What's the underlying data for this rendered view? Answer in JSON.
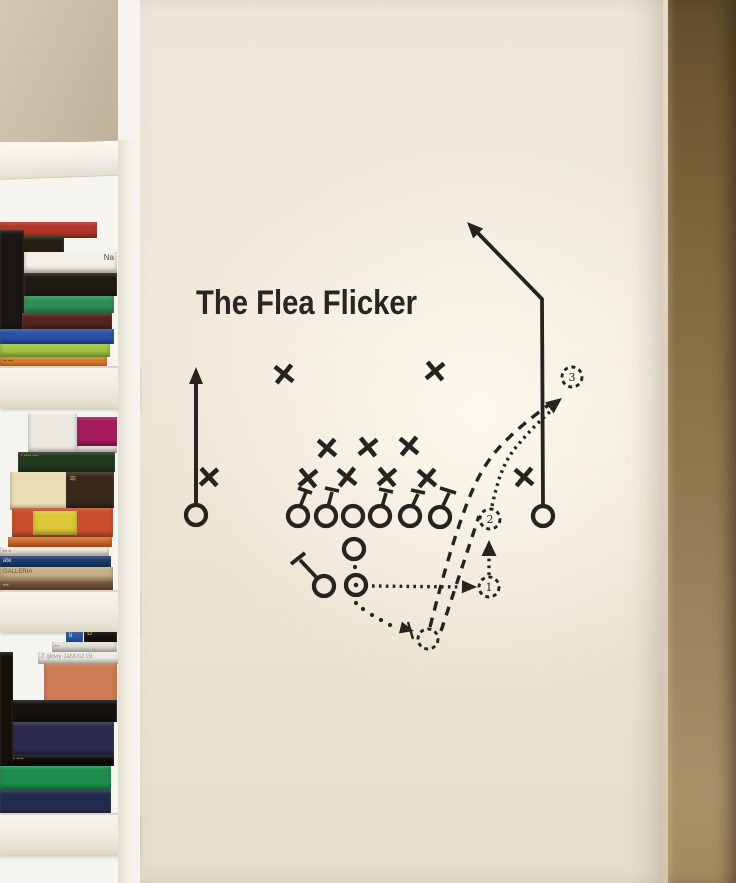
{
  "palette": {
    "ink": "#29231f",
    "wall_base": "#ece6d8",
    "shelf_white": "#f6f4ee",
    "upper_beige": "#c9bda8",
    "side_top": "#5e4c2b",
    "side_mid": "#8d7850",
    "side_bottom": "#a7926a",
    "title_color": "#2b2521"
  },
  "decal": {
    "title": "The Flea Flicker",
    "defenders": [
      {
        "x": 284,
        "y": 374,
        "rot": -6
      },
      {
        "x": 435,
        "y": 371,
        "rot": 5
      },
      {
        "x": 327,
        "y": 448,
        "rot": -4
      },
      {
        "x": 368,
        "y": 447,
        "rot": 6
      },
      {
        "x": 409,
        "y": 446,
        "rot": -5
      },
      {
        "x": 308,
        "y": 478,
        "rot": 5
      },
      {
        "x": 347,
        "y": 477,
        "rot": -6
      },
      {
        "x": 387,
        "y": 477,
        "rot": 4
      },
      {
        "x": 427,
        "y": 478,
        "rot": -4
      },
      {
        "x": 209,
        "y": 477,
        "rot": 3
      },
      {
        "x": 524,
        "y": 477,
        "rot": -5
      }
    ],
    "linemen": [
      {
        "x": 298,
        "y": 516,
        "stick": [
          300,
          507,
          306,
          492
        ],
        "bar": [
          298,
          488,
          312,
          493
        ]
      },
      {
        "x": 326,
        "y": 516,
        "stick": [
          328,
          507,
          332,
          492
        ],
        "bar": [
          325,
          488,
          339,
          491
        ]
      },
      {
        "x": 353,
        "y": 516
      },
      {
        "x": 380,
        "y": 516,
        "stick": [
          382,
          507,
          386,
          493
        ],
        "bar": [
          379,
          489,
          393,
          492
        ]
      },
      {
        "x": 410,
        "y": 516,
        "stick": [
          412,
          507,
          418,
          494
        ],
        "bar": [
          411,
          490,
          425,
          493
        ]
      },
      {
        "x": 440,
        "y": 517,
        "stick": [
          442,
          508,
          449,
          493
        ],
        "bar": [
          440,
          488,
          456,
          493
        ]
      }
    ],
    "backs": {
      "blocker": {
        "x": 324,
        "y": 586,
        "stick": [
          317,
          578,
          300,
          560
        ],
        "bar": [
          291,
          564,
          305,
          553
        ]
      },
      "qb": {
        "x": 354,
        "y": 549
      },
      "rb": {
        "x": 356,
        "y": 585
      }
    },
    "receivers": {
      "left": {
        "circle": [
          196,
          515
        ],
        "line": [
          196,
          503,
          196,
          380
        ],
        "arrow": {
          "tip": [
            196,
            367
          ],
          "ang": -90
        }
      },
      "right": {
        "circle": [
          543,
          516
        ],
        "poly": "543,504 542,299 472,227",
        "arrow": {
          "tip": [
            467,
            222
          ],
          "ang": -134
        }
      }
    },
    "routes": {
      "qb_drop_dots": [
        [
          355,
          567
        ],
        [
          356,
          603
        ],
        [
          363,
          609
        ],
        [
          372,
          615
        ],
        [
          381,
          620
        ],
        [
          390,
          625
        ]
      ],
      "qb_drop_arrow": {
        "tip": [
          414,
          631
        ],
        "ang": 14
      },
      "tick": [
        408,
        622,
        413,
        639
      ],
      "handoff_dotted": [
        372,
        586,
        460,
        587
      ],
      "handoff_arrow": {
        "tip": [
          477,
          587
        ],
        "ang": 1
      },
      "up_dotted": [
        489,
        575,
        489,
        553
      ],
      "up_arrow": {
        "tip": [
          489,
          540
        ],
        "ang": -90
      },
      "deep_dotted": "M492,506 C497,483 503,462 517,446 C531,429 543,418 553,409",
      "deep_arrow": {
        "tip": [
          562,
          398
        ],
        "ang": -38
      },
      "dash_long": "M430,627 C441,584 450,551 462,517 C473,486 483,466 497,450 C512,433 534,415 557,399",
      "dash_short": [
        441,
        631,
        479,
        516
      ]
    },
    "ghosts": [
      {
        "label": "1",
        "x": 489,
        "y": 587
      },
      {
        "label": "2",
        "x": 490,
        "y": 519
      },
      {
        "label": "3",
        "x": 572,
        "y": 377
      },
      {
        "label": "",
        "x": 428,
        "y": 639
      }
    ]
  },
  "bookshelf": {
    "boards": [
      {
        "y": 366,
        "h": 40
      },
      {
        "y": 590,
        "h": 40
      },
      {
        "y": 813,
        "h": 40
      }
    ],
    "books": [
      {
        "x": 0,
        "y": 222,
        "w": 97,
        "h": 16,
        "c": "#b23527"
      },
      {
        "x": 0,
        "y": 236,
        "w": 64,
        "h": 26,
        "c": "#251e17"
      },
      {
        "x": 0,
        "y": 230,
        "w": 24,
        "h": 100,
        "c": "#1b1613"
      },
      {
        "x": 24,
        "y": 252,
        "w": 93,
        "h": 21,
        "c": "#f2efe7",
        "label": "Na",
        "lc": "#4a4a44",
        "la": "right",
        "fs": 8
      },
      {
        "x": 24,
        "y": 273,
        "w": 93,
        "h": 23,
        "c": "#201a14"
      },
      {
        "x": 24,
        "y": 296,
        "w": 90,
        "h": 17,
        "c": "#2f8f56"
      },
      {
        "x": 22,
        "y": 313,
        "w": 90,
        "h": 16,
        "c": "#54251e"
      },
      {
        "x": 0,
        "y": 329,
        "w": 114,
        "h": 15,
        "c": "#2b52a6"
      },
      {
        "x": 0,
        "y": 344,
        "w": 110,
        "h": 13,
        "c": "#a1c440"
      },
      {
        "x": 0,
        "y": 357,
        "w": 107,
        "h": 11,
        "c": "#d5792e",
        "label": "▪▪ ▪▪▪",
        "lc": "#7a3c14",
        "fs": 5
      },
      {
        "x": 28,
        "y": 414,
        "w": 49,
        "h": 39,
        "c": "#ebe8df"
      },
      {
        "x": 77,
        "y": 417,
        "w": 40,
        "h": 29,
        "c": "#a61b5e"
      },
      {
        "x": 77,
        "y": 446,
        "w": 40,
        "h": 7,
        "c": "#e7e2d6"
      },
      {
        "x": 18,
        "y": 452,
        "w": 97,
        "h": 20,
        "c": "#20391f",
        "label": "▪ ▪▪▪▪ ▪▪▪",
        "lc": "#c4692a",
        "fs": 5
      },
      {
        "x": 10,
        "y": 472,
        "w": 59,
        "h": 38,
        "c": "#e8ddb4"
      },
      {
        "x": 66,
        "y": 472,
        "w": 48,
        "h": 36,
        "c": "#37281a",
        "label": "≋",
        "lc": "#b5a077",
        "fs": 9
      },
      {
        "x": 12,
        "y": 508,
        "w": 101,
        "h": 29,
        "c": "#ca4e2e"
      },
      {
        "x": 33,
        "y": 511,
        "w": 44,
        "h": 24,
        "c": "#dcc838"
      },
      {
        "x": 8,
        "y": 537,
        "w": 104,
        "h": 10,
        "c": "#d0702f"
      },
      {
        "x": 0,
        "y": 547,
        "w": 109,
        "h": 9,
        "c": "#eeebe2",
        "label": "▪▪▪ ▪▪",
        "lc": "#8a4438",
        "fs": 4
      },
      {
        "x": 0,
        "y": 556,
        "w": 111,
        "h": 11,
        "c": "#1c3c6e",
        "label": "ate",
        "lc": "#d8e0ec",
        "la": "left",
        "fs": 6
      },
      {
        "x": 0,
        "y": 567,
        "w": 113,
        "h": 14,
        "c": "#c7b083",
        "label": "GALLERIA",
        "lc": "#6a5232",
        "fs": 6
      },
      {
        "x": 0,
        "y": 581,
        "w": 113,
        "h": 11,
        "c": "#6a492c",
        "label": "▪▪▪▪",
        "lc": "#d8cbb2",
        "fs": 4
      },
      {
        "x": 66,
        "y": 630,
        "w": 17,
        "h": 13,
        "c": "#2a5da6",
        "label": "li",
        "lc": "#d5e5f5",
        "fs": 7
      },
      {
        "x": 84,
        "y": 627,
        "w": 33,
        "h": 15,
        "c": "#181411",
        "label": "B",
        "lc": "#d4b73b",
        "fs": 8
      },
      {
        "x": 52,
        "y": 642,
        "w": 65,
        "h": 10,
        "c": "#e6e2d7",
        "label": "▪▪▪",
        "lc": "#777777",
        "fs": 4
      },
      {
        "x": 38,
        "y": 652,
        "w": 82,
        "h": 12,
        "c": "#efece4",
        "label": "Z głowy JaNUsz Gł",
        "lc": "#8890a8",
        "fs": 6
      },
      {
        "x": 44,
        "y": 663,
        "w": 73,
        "h": 43,
        "c": "#cd7d55"
      },
      {
        "x": 8,
        "y": 700,
        "w": 109,
        "h": 22,
        "c": "#161210"
      },
      {
        "x": 0,
        "y": 722,
        "w": 114,
        "h": 33,
        "c": "#2b2a4c"
      },
      {
        "x": 0,
        "y": 755,
        "w": 114,
        "h": 11,
        "c": "#0f0c0a",
        "label": "▪▪▪▪ ▪▪ ▪▪▪▪",
        "lc": "#b0752d",
        "fs": 5
      },
      {
        "x": 0,
        "y": 766,
        "w": 111,
        "h": 24,
        "c": "#1e8c4d"
      },
      {
        "x": 0,
        "y": 790,
        "w": 111,
        "h": 25,
        "c": "#222a50"
      },
      {
        "x": 0,
        "y": 652,
        "w": 13,
        "h": 112,
        "c": "#131009"
      }
    ]
  }
}
